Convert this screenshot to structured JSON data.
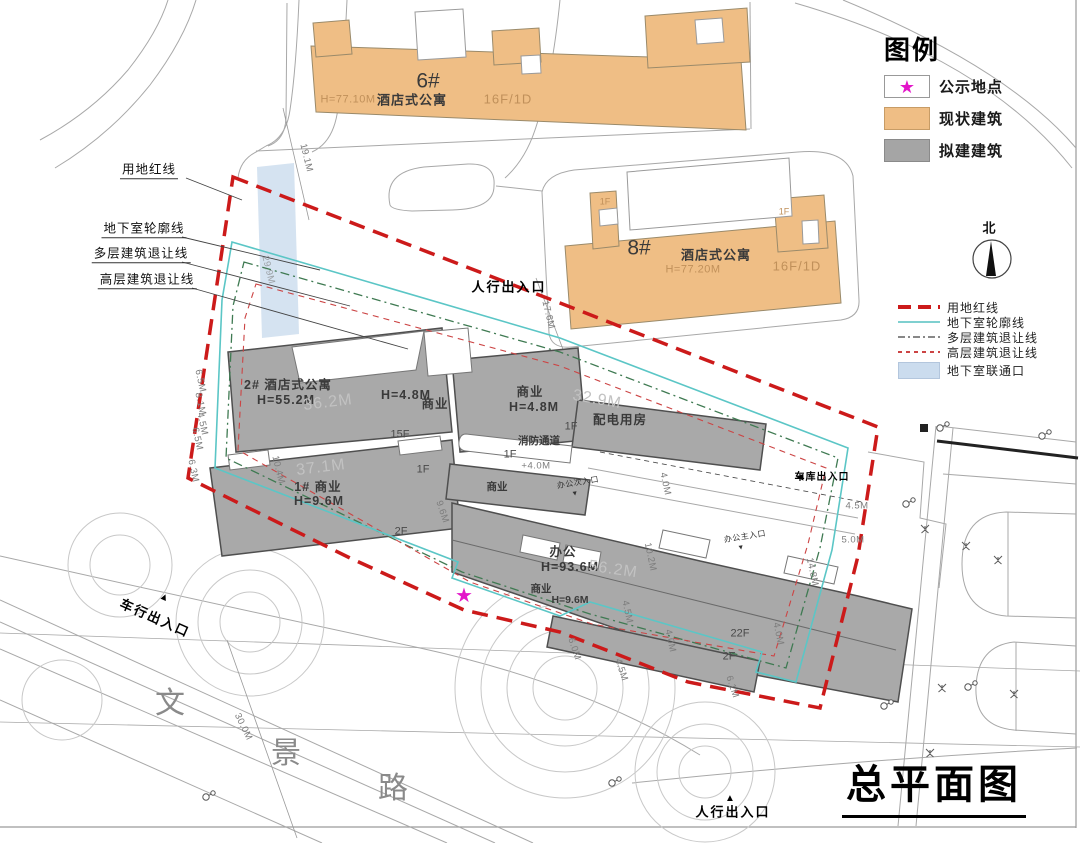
{
  "drawing_title": "总平面图",
  "road_name": "文景路",
  "compass": {
    "label": "北"
  },
  "colors": {
    "existing_building": "#EFBE85",
    "proposed_building": "#A5A5A5",
    "site_red_line": "#CC1A1A",
    "basement_outline": "#5BC6C6",
    "basement_connector_fill": "#CBDCEE",
    "public_notice_star": "#E315C9"
  },
  "legend": {
    "title": "图例",
    "items": [
      {
        "label": "公示地点",
        "glyph": "★",
        "swatch": "star"
      },
      {
        "label": "现状建筑",
        "swatch": "orange"
      },
      {
        "label": "拟建建筑",
        "swatch": "gray"
      }
    ]
  },
  "line_legend": [
    {
      "label": "用地红线",
      "style": "red-bold-dash"
    },
    {
      "label": "地下室轮廓线",
      "style": "cyan-solid"
    },
    {
      "label": "多层建筑退让线",
      "style": "gray-dash-dot"
    },
    {
      "label": "高层建筑退让线",
      "style": "red-fine-dash"
    },
    {
      "label": "地下室联通口",
      "style": "blue-fill"
    }
  ],
  "annotations": [
    {
      "name": "callout-site-red-line",
      "text": "用地红线",
      "x": 149,
      "y": 171,
      "cls": "callout"
    },
    {
      "name": "callout-basement-outline",
      "text": "地下室轮廓线",
      "x": 144,
      "y": 230,
      "cls": "callout"
    },
    {
      "name": "callout-multistorey-setback",
      "text": "多层建筑退让线",
      "x": 141,
      "y": 255,
      "cls": "callout"
    },
    {
      "name": "callout-highrise-setback",
      "text": "高层建筑退让线",
      "x": 147,
      "y": 281,
      "cls": "callout"
    },
    {
      "name": "entrance-pedestrian-north",
      "text": "人行出入口",
      "x": 509,
      "y": 287,
      "cls": "entrance"
    },
    {
      "name": "entrance-pedestrian-south",
      "text": "人行出入口",
      "x": 733,
      "y": 812,
      "cls": "entrance"
    },
    {
      "name": "arrow-up-icon",
      "text": "▲",
      "x": 730,
      "y": 799,
      "cls": "tri"
    },
    {
      "name": "entrance-vehicle",
      "text": "车行出入口",
      "x": 155,
      "y": 618,
      "rot": 24,
      "cls": "entrance"
    },
    {
      "name": "arrow-up-icon",
      "text": "▲",
      "x": 164,
      "y": 598,
      "rot": 24,
      "cls": "tri"
    },
    {
      "name": "entrance-garage",
      "text": "车库出入口",
      "x": 822,
      "y": 478,
      "cls": "entrance-sm"
    },
    {
      "name": "arrow-left-icon",
      "text": "◀",
      "x": 800,
      "y": 477,
      "cls": "tri-sm"
    },
    {
      "name": "entrance-office-main",
      "text": "办公主入口",
      "x": 745,
      "y": 537,
      "rot": -9,
      "cls": "entrance-xs"
    },
    {
      "name": "arrow-down-icon",
      "text": "▼",
      "x": 741,
      "y": 548,
      "rot": -9,
      "cls": "tri-xs"
    },
    {
      "name": "entrance-office-secondary",
      "text": "办公次入口",
      "x": 578,
      "y": 483,
      "rot": -9,
      "cls": "entrance-xs"
    },
    {
      "name": "arrow-down-icon",
      "text": "▼",
      "x": 575,
      "y": 494,
      "rot": -9,
      "cls": "tri-xs"
    },
    {
      "name": "public-notice-star",
      "text": "★",
      "x": 464,
      "y": 596,
      "cls": "star-mark"
    },
    {
      "name": "bldg-6-id",
      "text": "6#",
      "x": 428,
      "y": 81,
      "cls": "bldg-id"
    },
    {
      "name": "bldg-6-use",
      "text": "酒店式公寓",
      "x": 412,
      "y": 100,
      "cls": "bldg-name"
    },
    {
      "name": "bldg-6-height",
      "text": "H=77.10M",
      "x": 348,
      "y": 100,
      "cls": "bldg-faint"
    },
    {
      "name": "bldg-6-floors",
      "text": "16F/1D",
      "x": 508,
      "y": 99,
      "cls": "bldg-faint-lg"
    },
    {
      "name": "bldg-8-id",
      "text": "8#",
      "x": 639,
      "y": 248,
      "cls": "bldg-id"
    },
    {
      "name": "bldg-8-use",
      "text": "酒店式公寓",
      "x": 716,
      "y": 255,
      "cls": "bldg-name"
    },
    {
      "name": "bldg-8-height",
      "text": "H=77.20M",
      "x": 693,
      "y": 270,
      "cls": "bldg-faint"
    },
    {
      "name": "bldg-8-floors",
      "text": "16F/1D",
      "x": 797,
      "y": 266,
      "cls": "bldg-faint-lg"
    },
    {
      "name": "floor-label",
      "text": "1F",
      "x": 605,
      "y": 202,
      "cls": "bldg-faint-sm"
    },
    {
      "name": "floor-label",
      "text": "1F",
      "x": 784,
      "y": 212,
      "cls": "bldg-faint-sm"
    },
    {
      "name": "bldg-2-label",
      "text": "2# 酒店式公寓",
      "x": 288,
      "y": 385,
      "cls": "bldg-label"
    },
    {
      "name": "bldg-2-height",
      "text": "H=55.2M",
      "x": 286,
      "y": 400,
      "cls": "bldg-label"
    },
    {
      "name": "bldg-1-label",
      "text": "1# 商业",
      "x": 318,
      "y": 487,
      "cls": "bldg-label"
    },
    {
      "name": "bldg-1-height",
      "text": "H=9.6M",
      "x": 319,
      "y": 501,
      "cls": "bldg-label"
    },
    {
      "name": "bldg-commercial-height",
      "text": "H=4.8M",
      "x": 406,
      "y": 395,
      "cls": "bldg-label"
    },
    {
      "name": "bldg-commercial",
      "text": "商业",
      "x": 435,
      "y": 404,
      "cls": "bldg-label"
    },
    {
      "name": "bldg-commercial",
      "text": "商业",
      "x": 530,
      "y": 392,
      "cls": "bldg-label"
    },
    {
      "name": "bldg-commercial-height",
      "text": "H=4.8M",
      "x": 534,
      "y": 407,
      "cls": "bldg-label"
    },
    {
      "name": "bldg-power-room",
      "text": "配电用房",
      "x": 620,
      "y": 420,
      "cls": "bldg-label"
    },
    {
      "name": "fire-lane-label",
      "text": "消防通道",
      "x": 539,
      "y": 441,
      "cls": "bldg-label-sm"
    },
    {
      "name": "bldg-commercial",
      "text": "商业",
      "x": 497,
      "y": 487,
      "cls": "bldg-label-sm"
    },
    {
      "name": "bldg-office",
      "text": "办公",
      "x": 563,
      "y": 552,
      "cls": "bldg-label"
    },
    {
      "name": "bldg-office-height",
      "text": "H=93.6M",
      "x": 570,
      "y": 567,
      "cls": "bldg-label"
    },
    {
      "name": "bldg-commercial",
      "text": "商业",
      "x": 541,
      "y": 589,
      "cls": "bldg-label-sm"
    },
    {
      "name": "bldg-commercial-height",
      "text": "H=9.6M",
      "x": 570,
      "y": 600,
      "cls": "bldg-label-sm"
    },
    {
      "name": "floor-label",
      "text": "15F",
      "x": 400,
      "y": 435,
      "cls": "floor"
    },
    {
      "name": "floor-label",
      "text": "1F",
      "x": 423,
      "y": 470,
      "cls": "floor"
    },
    {
      "name": "floor-label",
      "text": "2F",
      "x": 401,
      "y": 532,
      "cls": "floor"
    },
    {
      "name": "floor-label",
      "text": "1F",
      "x": 571,
      "y": 427,
      "cls": "floor"
    },
    {
      "name": "floor-label",
      "text": "1F",
      "x": 510,
      "y": 455,
      "cls": "floor"
    },
    {
      "name": "floor-label",
      "text": "22F",
      "x": 740,
      "y": 634,
      "cls": "floor"
    },
    {
      "name": "floor-label",
      "text": "2F",
      "x": 729,
      "y": 657,
      "cls": "floor"
    },
    {
      "name": "dimension",
      "text": "19.1M",
      "x": 306,
      "y": 158,
      "rot": 76,
      "cls": "dim"
    },
    {
      "name": "dimension",
      "text": "29.9M",
      "x": 268,
      "y": 270,
      "rot": 76,
      "cls": "dim dim-faint"
    },
    {
      "name": "dimension",
      "text": "17.6M",
      "x": 548,
      "y": 315,
      "rot": 76,
      "cls": "dim"
    },
    {
      "name": "dimension",
      "text": "36.2M",
      "x": 328,
      "y": 403,
      "rot": -7,
      "cls": "dim-big"
    },
    {
      "name": "dimension",
      "text": "37.1M",
      "x": 321,
      "y": 468,
      "rot": -7,
      "cls": "dim-big"
    },
    {
      "name": "dimension",
      "text": "10.4M",
      "x": 278,
      "y": 470,
      "rot": 76,
      "cls": "dim"
    },
    {
      "name": "dimension",
      "text": "6.5M",
      "x": 200,
      "y": 381,
      "rot": 78,
      "cls": "dim"
    },
    {
      "name": "dimension",
      "text": "8.1M",
      "x": 200,
      "y": 404,
      "rot": 78,
      "cls": "dim"
    },
    {
      "name": "dimension",
      "text": "4.5M",
      "x": 202,
      "y": 424,
      "rot": 78,
      "cls": "dim"
    },
    {
      "name": "dimension",
      "text": "6.5M",
      "x": 197,
      "y": 439,
      "rot": 78,
      "cls": "dim"
    },
    {
      "name": "dimension",
      "text": "6.3M",
      "x": 193,
      "y": 471,
      "rot": 78,
      "cls": "dim"
    },
    {
      "name": "dimension",
      "text": "9.6M",
      "x": 442,
      "y": 512,
      "rot": 72,
      "cls": "dim"
    },
    {
      "name": "dimension",
      "text": "32.9M",
      "x": 597,
      "y": 400,
      "rot": 10,
      "cls": "dim-big"
    },
    {
      "name": "dimension",
      "text": "+4.0M",
      "x": 536,
      "y": 466,
      "cls": "dim"
    },
    {
      "name": "dimension",
      "text": "4.0M",
      "x": 665,
      "y": 484,
      "rot": 78,
      "cls": "dim"
    },
    {
      "name": "dimension",
      "text": "56.2M",
      "x": 613,
      "y": 570,
      "rot": 8,
      "cls": "dim-big"
    },
    {
      "name": "dimension",
      "text": "10.2M",
      "x": 650,
      "y": 557,
      "rot": 78,
      "cls": "dim"
    },
    {
      "name": "dimension",
      "text": "4.5M",
      "x": 627,
      "y": 612,
      "rot": 78,
      "cls": "dim"
    },
    {
      "name": "dimension",
      "text": "6.0M",
      "x": 574,
      "y": 649,
      "rot": 72,
      "cls": "dim"
    },
    {
      "name": "dimension",
      "text": "4.5M",
      "x": 621,
      "y": 670,
      "rot": 72,
      "cls": "dim"
    },
    {
      "name": "dimension",
      "text": "4.0M",
      "x": 670,
      "y": 641,
      "rot": 78,
      "cls": "dim"
    },
    {
      "name": "dimension",
      "text": "6.1M",
      "x": 732,
      "y": 687,
      "rot": 72,
      "cls": "dim"
    },
    {
      "name": "dimension",
      "text": "4.0M",
      "x": 778,
      "y": 634,
      "rot": 78,
      "cls": "dim"
    },
    {
      "name": "dimension",
      "text": "14.8M",
      "x": 812,
      "y": 572,
      "rot": 78,
      "cls": "dim"
    },
    {
      "name": "dimension",
      "text": "4.5M",
      "x": 857,
      "y": 506,
      "cls": "dim"
    },
    {
      "name": "dimension",
      "text": "5.0M",
      "x": 853,
      "y": 540,
      "cls": "dim"
    },
    {
      "name": "dimension",
      "text": "30.0M",
      "x": 243,
      "y": 727,
      "rot": 64,
      "cls": "dim"
    },
    {
      "name": "road-name-char",
      "text": "文",
      "x": 170,
      "y": 704,
      "cls": "road-char"
    },
    {
      "name": "road-name-char",
      "text": "景",
      "x": 286,
      "y": 754,
      "cls": "road-char"
    },
    {
      "name": "road-name-char",
      "text": "路",
      "x": 393,
      "y": 789,
      "cls": "road-char"
    },
    {
      "name": "north-label",
      "text": "北",
      "x": 989,
      "y": 228,
      "cls": "north-label"
    }
  ]
}
